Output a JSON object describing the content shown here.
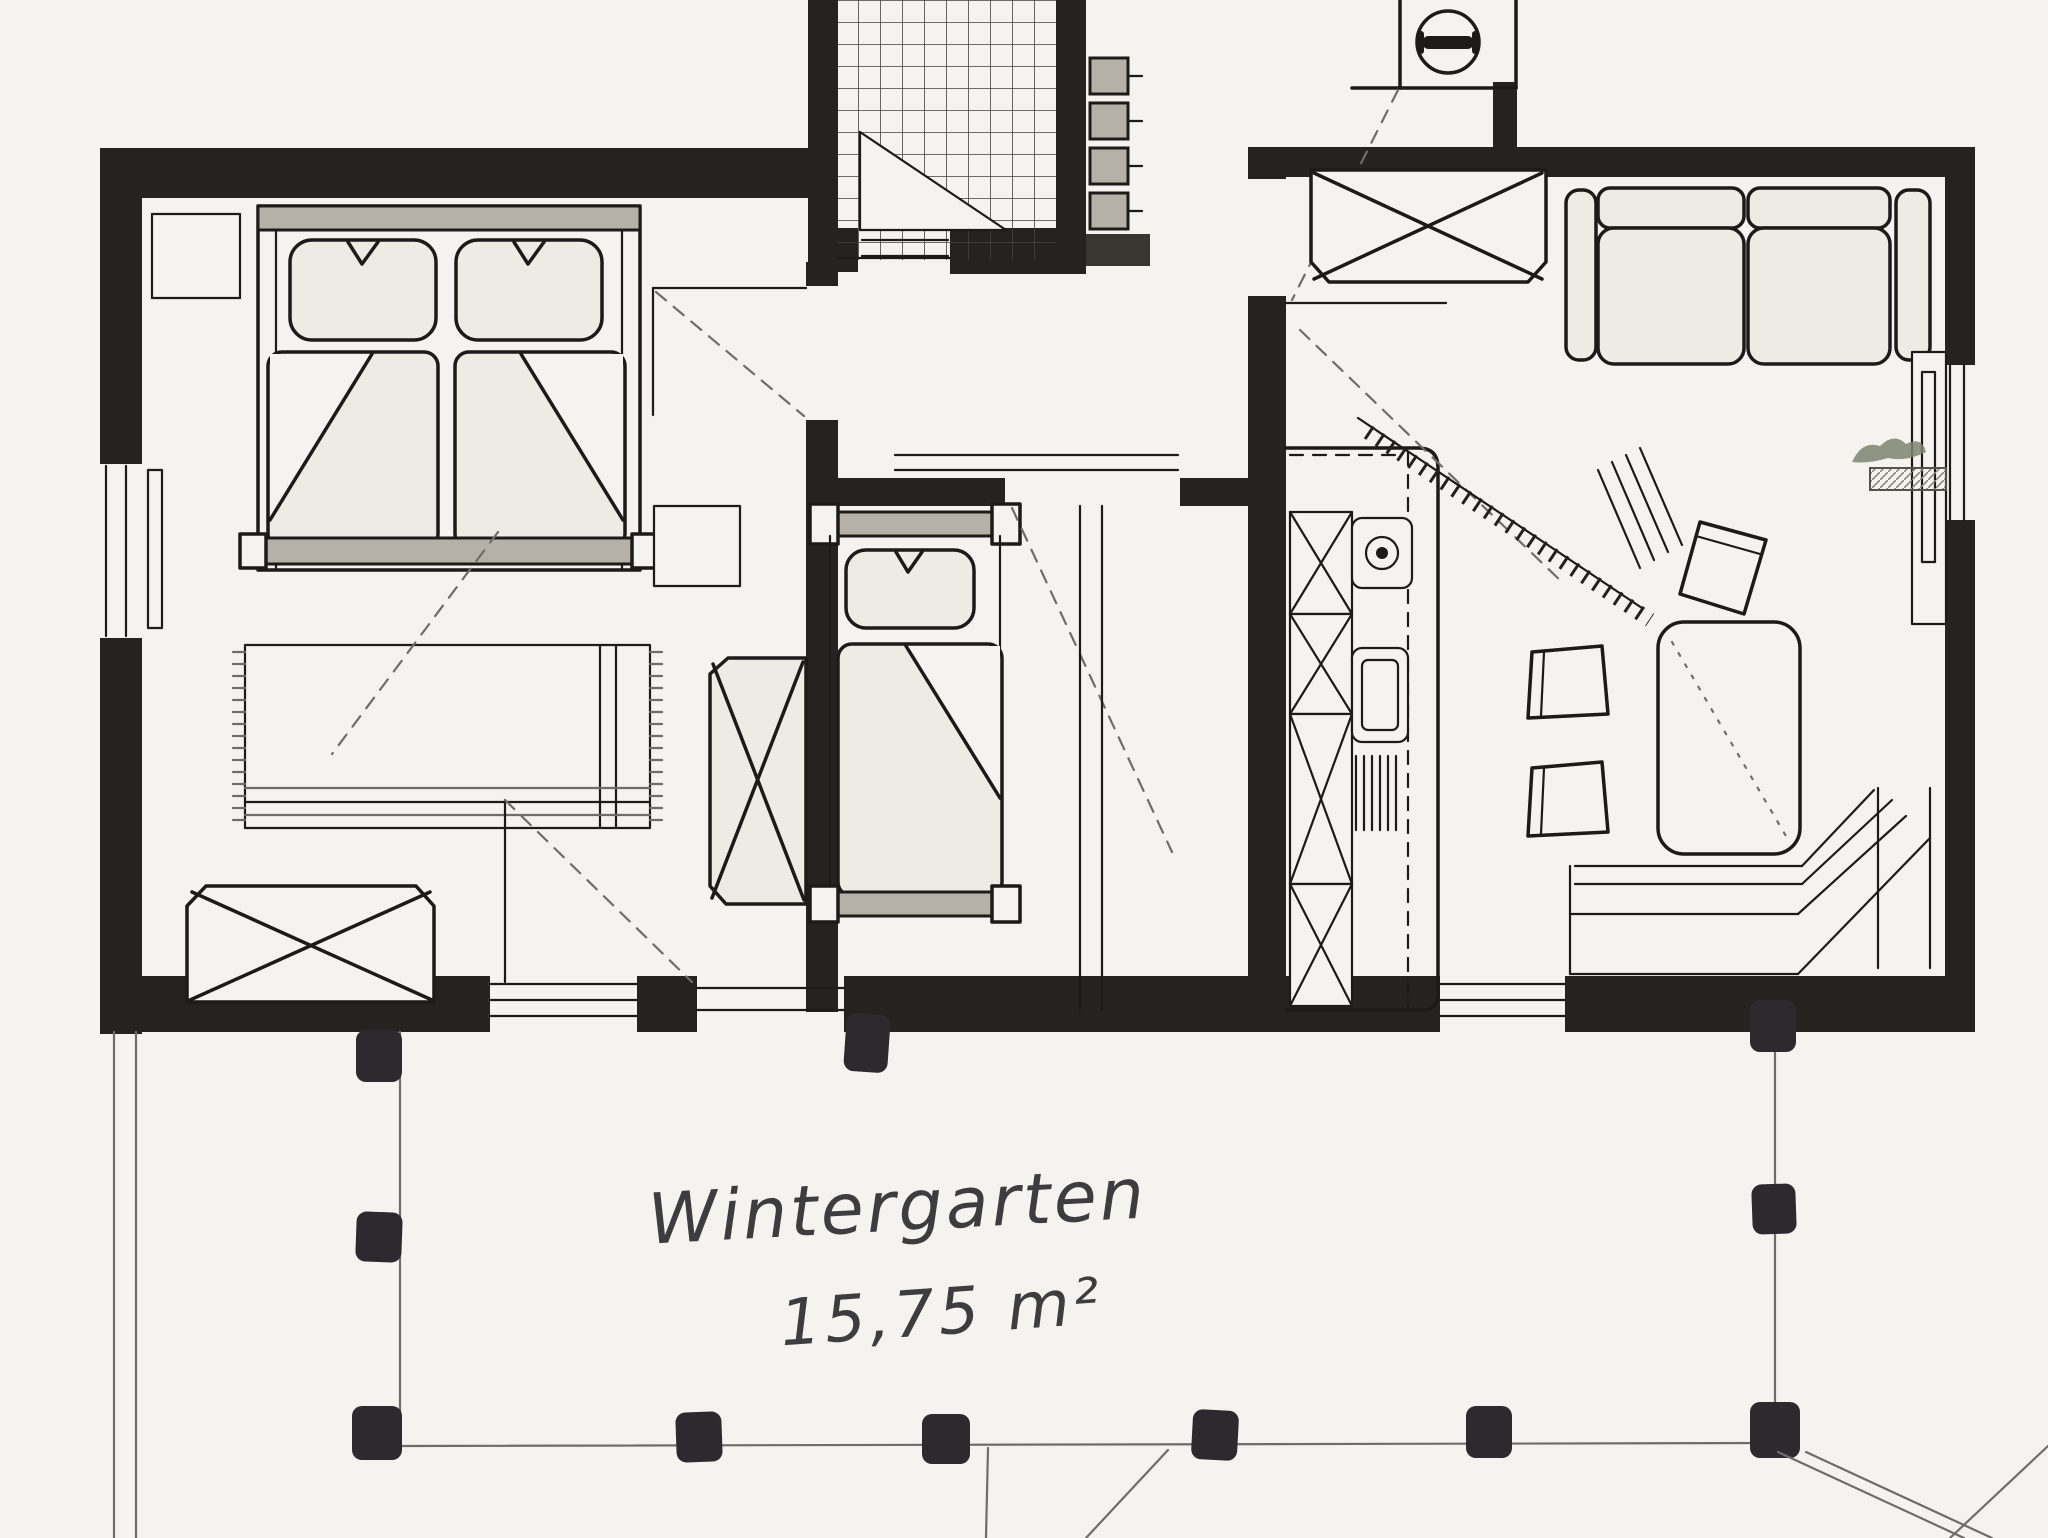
{
  "document": {
    "kind": "scanned hand-drawn floor plan",
    "language": "de"
  },
  "labels": {
    "wintergarten": "Wintergarten",
    "area": "15,75 m²"
  },
  "areas": [
    {
      "name": "bedroom-left",
      "labeled": false
    },
    {
      "name": "small-bedroom-middle",
      "labeled": false
    },
    {
      "name": "living-kitchen-right",
      "labeled": false
    },
    {
      "name": "tiled-entrance-hall",
      "labeled": false
    },
    {
      "name": "wintergarten-terrace",
      "labeled": true,
      "label": "Wintergarten",
      "area_label": "15,75 m²"
    }
  ],
  "furniture_icons": [
    "double-bed-icon",
    "pillow-icon",
    "duvet-icon",
    "nightstand-icon",
    "rug-icon",
    "chest-x-icon",
    "wardrobe-x-icon",
    "single-bed-icon",
    "stool-icon",
    "kitchen-counter-icon",
    "sink-icon",
    "stove-icon",
    "grill-icon",
    "sofa-icon",
    "dining-table-icon",
    "chair-icon",
    "corner-bench-icon",
    "sideboard-icon",
    "plant-icon",
    "door-swing-icon",
    "window-icon",
    "stair-ladder-icon",
    "chimney-lamp-icon",
    "terrace-post-icon",
    "tile-floor-icon"
  ],
  "colors": {
    "paper": "#f4f3ef",
    "ink": "#1d1b19",
    "wall": "#262220",
    "soft_grey": "#b6b1a8",
    "pencil": "#6f6d69",
    "post": "#2c2a2e",
    "plant": "#7c8270"
  }
}
